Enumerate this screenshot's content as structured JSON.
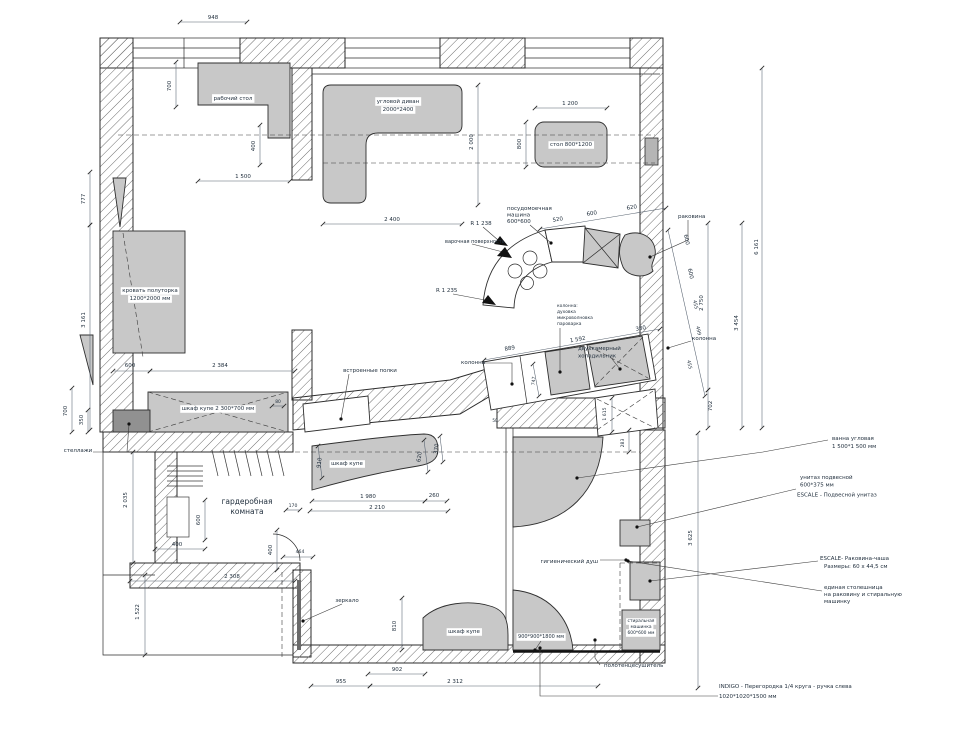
{
  "drawing": {
    "title": "apartment furniture layout plan",
    "colors": {
      "furniture": "#c8c8c8",
      "wall_hatch": "#6e6e6e",
      "dim_text": "#3f4f63",
      "label_text": "#1f2d3d",
      "callout_text": "#6e4646"
    },
    "labels": [
      {
        "n": "desk-label",
        "t": "рабочий стол",
        "x": 233,
        "y": 100,
        "bg": 1
      },
      {
        "n": "corner-sofa-label-1",
        "t": "угловой диван",
        "x": 398,
        "y": 103,
        "bg": 1
      },
      {
        "n": "corner-sofa-label-2",
        "t": "2000*2400",
        "x": 398,
        "y": 111,
        "bg": 1
      },
      {
        "n": "dining-table-label",
        "t": "стол 800*1200",
        "x": 571,
        "y": 146,
        "bg": 1
      },
      {
        "n": "bed-label-1",
        "t": "кровать полуторка",
        "x": 150,
        "y": 292,
        "bg": 1
      },
      {
        "n": "bed-label-2",
        "t": "1200*2000 мм",
        "x": 150,
        "y": 300,
        "bg": 1
      },
      {
        "n": "wardrobe-2300-label",
        "t": "шкаф купе 2 300*700 мм",
        "x": 218,
        "y": 410,
        "bg": 1
      },
      {
        "n": "shelving-label",
        "t": "стеллажи",
        "x": 78,
        "y": 452
      },
      {
        "n": "builtin-shelves-label",
        "t": "встроенные полки",
        "x": 370,
        "y": 372
      },
      {
        "n": "dressing-room-label-1",
        "t": "гардеробная",
        "x": 247,
        "y": 504,
        "s": 7.5
      },
      {
        "n": "dressing-room-label-2",
        "t": "комната",
        "x": 247,
        "y": 514,
        "s": 7.5
      },
      {
        "n": "hall-wardrobe-label",
        "t": "шкаф купе",
        "x": 347,
        "y": 465,
        "bg": 1
      },
      {
        "n": "mirror-label",
        "t": "зеркало",
        "x": 347,
        "y": 602
      },
      {
        "n": "bottom-wardrobe-label",
        "t": "шкаф купе",
        "x": 464,
        "y": 633,
        "bg": 1
      },
      {
        "n": "dishwasher-label-1",
        "t": "посудомоечная",
        "x": 507,
        "y": 210,
        "a": "start"
      },
      {
        "n": "dishwasher-label-2",
        "t": "машина",
        "x": 507,
        "y": 216.5,
        "a": "start"
      },
      {
        "n": "dishwasher-label-3",
        "t": "600*600",
        "x": 507,
        "y": 223,
        "a": "start"
      },
      {
        "n": "radius-label-1",
        "t": "R 1 238",
        "x": 481,
        "y": 225
      },
      {
        "n": "cooktop-label",
        "t": "варочная поверхность",
        "x": 445,
        "y": 243,
        "a": "start",
        "s": 5
      },
      {
        "n": "radius-label-2",
        "t": "R 1 235",
        "x": 436,
        "y": 292,
        "a": "start"
      },
      {
        "n": "column-left-label",
        "t": "колонна",
        "x": 461,
        "y": 364,
        "a": "start"
      },
      {
        "n": "column-stack-label-1",
        "t": "колонна:",
        "x": 557,
        "y": 307,
        "a": "start",
        "s": 4.4
      },
      {
        "n": "column-stack-label-2",
        "t": "духовка",
        "x": 557,
        "y": 313,
        "a": "start",
        "s": 4.4
      },
      {
        "n": "column-stack-label-3",
        "t": "микроволновка",
        "x": 557,
        "y": 319,
        "a": "start",
        "s": 4.4
      },
      {
        "n": "column-stack-label-4",
        "t": "пароварка",
        "x": 557,
        "y": 325,
        "a": "start",
        "s": 4.4
      },
      {
        "n": "fridge-label-1",
        "t": "двухкамерный",
        "x": 578,
        "y": 350,
        "a": "start"
      },
      {
        "n": "fridge-label-2",
        "t": "холодильник",
        "x": 578,
        "y": 357.5,
        "a": "start"
      },
      {
        "n": "kitchen-sink-label",
        "t": "раковина",
        "x": 678,
        "y": 218,
        "a": "start"
      },
      {
        "n": "column-right-label",
        "t": "колонна",
        "x": 692,
        "y": 340,
        "a": "start"
      },
      {
        "n": "bath-callout-1",
        "t": "ванна угловая",
        "x": 832,
        "y": 440,
        "a": "start",
        "c": "#6e4646"
      },
      {
        "n": "bath-callout-2",
        "t": "1 500*1 500 мм",
        "x": 832,
        "y": 448,
        "a": "start",
        "c": "#6e4646"
      },
      {
        "n": "toilet-callout-1",
        "t": "унитаз подвесной",
        "x": 800,
        "y": 479,
        "a": "start",
        "c": "#6e4646"
      },
      {
        "n": "toilet-callout-2",
        "t": "600*375 мм",
        "x": 800,
        "y": 486.5,
        "a": "start",
        "c": "#6e4646"
      },
      {
        "n": "toilet-callout-3",
        "t": "ESCALE - Подвесной унитаз",
        "x": 797,
        "y": 496.5,
        "a": "start",
        "c": "#6e4646"
      },
      {
        "n": "basin-callout-1",
        "t": "ESCALE- Раковина-чаша",
        "x": 820,
        "y": 560,
        "a": "start",
        "c": "#6e4646"
      },
      {
        "n": "basin-callout-2",
        "t": "Размеры: 60 x 44,5 см",
        "x": 824,
        "y": 568,
        "a": "start",
        "c": "#6e4646"
      },
      {
        "n": "countertop-callout-1",
        "t": "единая столешница",
        "x": 824,
        "y": 589,
        "a": "start",
        "c": "#6e4646"
      },
      {
        "n": "countertop-callout-2",
        "t": "на раковину и стиральную",
        "x": 824,
        "y": 596,
        "a": "start",
        "c": "#6e4646"
      },
      {
        "n": "countertop-callout-3",
        "t": "машинку",
        "x": 824,
        "y": 603,
        "a": "start",
        "c": "#6e4646"
      },
      {
        "n": "indigo-callout-1",
        "t": "INDIGO - Перегородка 1/4 круга - ручка слева",
        "x": 719,
        "y": 688,
        "a": "start",
        "c": "#6e4646"
      },
      {
        "n": "indigo-callout-2",
        "t": "1020*1020*1500 мм",
        "x": 719,
        "y": 698,
        "a": "start",
        "c": "#6e4646"
      },
      {
        "n": "hygienic-shower-label",
        "t": "гигиенический душ",
        "x": 598,
        "y": 563,
        "a": "end"
      },
      {
        "n": "shower-size-label",
        "t": "900*900*1800 мм",
        "x": 541,
        "y": 638,
        "bg": 1,
        "s": 5
      },
      {
        "n": "washer-label-1",
        "t": "стиральная",
        "x": 641,
        "y": 622,
        "s": 4.4,
        "bg": 1
      },
      {
        "n": "washer-label-2",
        "t": "машинка",
        "x": 641,
        "y": 628,
        "s": 4.4,
        "bg": 1
      },
      {
        "n": "washer-label-3",
        "t": "600*600 мм",
        "x": 641,
        "y": 634,
        "s": 4.4,
        "bg": 1
      },
      {
        "n": "towel-dryer-label",
        "t": "полотенцесушитель",
        "x": 604,
        "y": 667,
        "a": "start"
      }
    ],
    "dims": [
      {
        "t": "948",
        "x": 213,
        "y": 19
      },
      {
        "t": "700",
        "x": 171,
        "y": 86,
        "r": -90
      },
      {
        "t": "400",
        "x": 255,
        "y": 146,
        "r": -90
      },
      {
        "t": "1 500",
        "x": 243,
        "y": 178
      },
      {
        "t": "777",
        "x": 85,
        "y": 199,
        "r": -90
      },
      {
        "t": "3 161",
        "x": 85,
        "y": 320,
        "r": -90
      },
      {
        "t": "2 400",
        "x": 392,
        "y": 221
      },
      {
        "t": "2 000",
        "x": 473,
        "y": 142,
        "r": -90
      },
      {
        "t": "1 200",
        "x": 570,
        "y": 105
      },
      {
        "t": "800",
        "x": 521,
        "y": 144,
        "r": -90
      },
      {
        "t": "600",
        "x": 130,
        "y": 367
      },
      {
        "t": "2 384",
        "x": 220,
        "y": 367
      },
      {
        "t": "700",
        "x": 67,
        "y": 411,
        "r": -90
      },
      {
        "t": "350",
        "x": 83,
        "y": 420,
        "r": -90
      },
      {
        "t": "80",
        "x": 278,
        "y": 403,
        "s": 4.4
      },
      {
        "t": "910",
        "x": 321,
        "y": 463,
        "r": -82
      },
      {
        "t": "620",
        "x": 421,
        "y": 457,
        "r": -82
      },
      {
        "t": "370",
        "x": 438,
        "y": 449,
        "r": -82
      },
      {
        "t": "1 980",
        "x": 368,
        "y": 498
      },
      {
        "t": "260",
        "x": 434,
        "y": 497
      },
      {
        "t": "2 210",
        "x": 377,
        "y": 509
      },
      {
        "t": "170",
        "x": 293,
        "y": 507,
        "s": 4.6
      },
      {
        "t": "2 035",
        "x": 127,
        "y": 500,
        "r": -90
      },
      {
        "t": "600",
        "x": 200,
        "y": 520,
        "r": -90
      },
      {
        "t": "400",
        "x": 177,
        "y": 546
      },
      {
        "t": "400",
        "x": 272,
        "y": 550,
        "r": -90
      },
      {
        "t": "464",
        "x": 300,
        "y": 553,
        "s": 4.6
      },
      {
        "t": "2 308",
        "x": 232,
        "y": 578
      },
      {
        "t": "1 522",
        "x": 139,
        "y": 612,
        "r": -90
      },
      {
        "t": "955",
        "x": 341,
        "y": 683
      },
      {
        "t": "2 312",
        "x": 455,
        "y": 683
      },
      {
        "t": "902",
        "x": 397,
        "y": 671
      },
      {
        "t": "810",
        "x": 396,
        "y": 626,
        "r": -90
      },
      {
        "t": "3 625",
        "x": 692,
        "y": 538,
        "r": -90
      },
      {
        "t": "1 615",
        "x": 606,
        "y": 414,
        "r": -90,
        "s": 4.6
      },
      {
        "t": "283",
        "x": 624,
        "y": 443,
        "r": -90,
        "s": 4.6
      },
      {
        "t": "702",
        "x": 712,
        "y": 406,
        "r": -90
      },
      {
        "t": "2 750",
        "x": 703,
        "y": 303,
        "r": -90
      },
      {
        "t": "3 454",
        "x": 738,
        "y": 323,
        "r": -90
      },
      {
        "t": "6 161",
        "x": 758,
        "y": 247,
        "r": -90
      },
      {
        "t": "889",
        "x": 510,
        "y": 350,
        "r": -10
      },
      {
        "t": "1 592",
        "x": 578,
        "y": 341,
        "r": -10
      },
      {
        "t": "380",
        "x": 641,
        "y": 330,
        "r": -10
      },
      {
        "t": "520",
        "x": 558,
        "y": 221,
        "r": -9
      },
      {
        "t": "600",
        "x": 592,
        "y": 215,
        "r": -9
      },
      {
        "t": "620",
        "x": 632,
        "y": 209,
        "r": -9
      },
      {
        "t": "600",
        "x": 685,
        "y": 240,
        "r": 77
      },
      {
        "t": "600",
        "x": 689,
        "y": 274,
        "r": 77
      },
      {
        "t": "455",
        "x": 694,
        "y": 305,
        "r": 77,
        "s": 4.8
      },
      {
        "t": "499",
        "x": 697,
        "y": 331,
        "r": 77,
        "s": 4.8
      },
      {
        "t": "455",
        "x": 688,
        "y": 365,
        "r": 77,
        "s": 4.8
      },
      {
        "t": "747",
        "x": 535,
        "y": 381,
        "r": -85,
        "s": 4.6
      },
      {
        "t": "50",
        "x": 495,
        "y": 422,
        "s": 4.2
      }
    ],
    "dim_lines": [
      [
        180,
        22,
        247,
        22
      ],
      [
        176,
        62,
        176,
        107
      ],
      [
        260,
        125,
        260,
        165
      ],
      [
        198,
        181,
        290,
        181
      ],
      [
        90,
        172,
        90,
        225
      ],
      [
        90,
        225,
        90,
        430
      ],
      [
        323,
        224,
        462,
        224
      ],
      [
        478,
        85,
        478,
        205
      ],
      [
        535,
        108,
        607,
        108
      ],
      [
        526,
        122,
        526,
        167
      ],
      [
        113,
        371,
        150,
        371
      ],
      [
        150,
        371,
        295,
        371
      ],
      [
        72,
        388,
        72,
        432
      ],
      [
        88,
        410,
        88,
        432
      ],
      [
        540,
        229,
        666,
        208
      ],
      [
        668,
        230,
        705,
        396
      ],
      [
        484,
        360,
        660,
        329
      ],
      [
        708,
        223,
        708,
        390
      ],
      [
        708,
        390,
        708,
        428
      ],
      [
        742,
        223,
        742,
        428
      ],
      [
        762,
        68,
        762,
        428
      ],
      [
        698,
        433,
        698,
        688
      ],
      [
        612,
        398,
        612,
        432
      ],
      [
        629,
        430,
        629,
        452
      ],
      [
        312,
        501,
        425,
        501
      ],
      [
        425,
        501,
        447,
        501
      ],
      [
        310,
        511,
        448,
        511
      ],
      [
        133,
        452,
        133,
        563
      ],
      [
        145,
        575,
        145,
        655
      ],
      [
        205,
        500,
        205,
        540
      ],
      [
        155,
        549,
        205,
        549
      ],
      [
        277,
        530,
        277,
        570
      ],
      [
        283,
        557,
        313,
        557
      ],
      [
        130,
        581,
        295,
        581
      ],
      [
        311,
        686,
        370,
        686
      ],
      [
        370,
        686,
        598,
        686
      ],
      [
        368,
        674,
        425,
        674
      ],
      [
        402,
        598,
        402,
        650
      ],
      [
        286,
        510,
        300,
        510
      ],
      [
        318,
        446,
        322,
        478
      ],
      [
        424,
        440,
        428,
        472
      ],
      [
        440,
        436,
        443,
        462
      ],
      [
        272,
        406,
        284,
        406
      ],
      [
        533,
        364,
        539,
        396
      ]
    ],
    "leaders": [
      {
        "pts": [
          [
            530,
            225
          ],
          [
            551,
            243
          ]
        ]
      },
      {
        "pts": [
          [
            688,
            220
          ],
          [
            688,
            240
          ],
          [
            650,
            257
          ]
        ]
      },
      {
        "pts": [
          [
            482,
            363
          ],
          [
            512,
            363
          ],
          [
            512,
            384
          ]
        ]
      },
      {
        "pts": [
          [
            691,
            341
          ],
          [
            668,
            348
          ]
        ]
      },
      {
        "pts": [
          [
            560,
            328
          ],
          [
            560,
            372
          ]
        ]
      },
      {
        "pts": [
          [
            612,
            359
          ],
          [
            620,
            369
          ]
        ]
      },
      {
        "pts": [
          [
            349,
            374
          ],
          [
            341,
            419
          ]
        ]
      },
      {
        "pts": [
          [
            93,
            452
          ],
          [
            127,
            452
          ],
          [
            129,
            424
          ]
        ]
      },
      {
        "pts": [
          [
            342,
            604
          ],
          [
            303,
            621
          ]
        ]
      },
      {
        "pts": [
          [
            828,
            440
          ],
          [
            763,
            452
          ],
          [
            577,
            478
          ]
        ]
      },
      {
        "pts": [
          [
            796,
            489
          ],
          [
            637,
            527
          ]
        ]
      },
      {
        "pts": [
          [
            818,
            561
          ],
          [
            650,
            581
          ]
        ]
      },
      {
        "pts": [
          [
            822,
            591
          ],
          [
            628,
            561
          ]
        ]
      },
      {
        "pts": [
          [
            718,
            696
          ],
          [
            540,
            696
          ],
          [
            540,
            648
          ]
        ]
      },
      {
        "pts": [
          [
            600,
            665
          ],
          [
            595,
            658
          ],
          [
            595,
            640
          ]
        ]
      },
      {
        "pts": [
          [
            600,
            560
          ],
          [
            626,
            560
          ]
        ]
      },
      {
        "pts": [
          [
            541,
            641
          ],
          [
            535,
            650
          ]
        ]
      }
    ],
    "dash_lines": [
      [
        118,
        135,
        655,
        135
      ],
      [
        323,
        163,
        655,
        163
      ],
      [
        295,
        452,
        640,
        452
      ],
      [
        123,
        233,
        143,
        357
      ],
      [
        282,
        572,
        282,
        657
      ],
      [
        620,
        563,
        620,
        650
      ],
      [
        620,
        563,
        660,
        563
      ],
      [
        148,
        392,
        288,
        432
      ],
      [
        148,
        432,
        288,
        392
      ],
      [
        589,
        346,
        648,
        378
      ],
      [
        595,
        386,
        643,
        337
      ],
      [
        597,
        399,
        655,
        428
      ],
      [
        597,
        430,
        653,
        391
      ]
    ]
  }
}
